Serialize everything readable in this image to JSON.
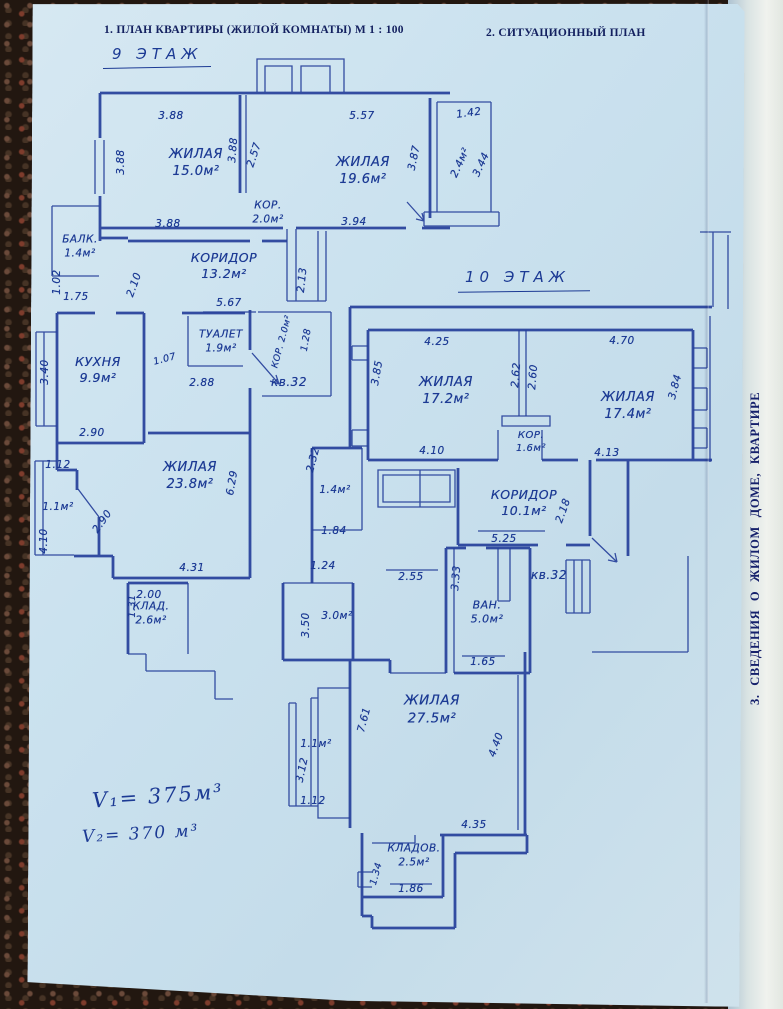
{
  "document": {
    "header_left": "1. ПЛАН КВАРТИРЫ (ЖИЛОЙ КОМНАТЫ) М 1 : 100",
    "header_right": "2. СИТУАЦИОННЫЙ ПЛАН",
    "side_note": "3. СВЕДЕНИЯ О ЖИЛОМ ДОМЕ, КВАРТИРЕ",
    "volume_line1": "V₁= 375м³",
    "volume_line2": "V₂= 370 м³"
  },
  "colors": {
    "paper": "#cde1ee",
    "ink_handwriting": "#1c3a94",
    "ink_plan": "#27419b",
    "ink_print": "#13205f",
    "background": "#221710"
  },
  "floor9": {
    "title": "9 ЭТАЖ",
    "labels": [
      {
        "t": "ЖИЛАЯ\n15.0м²",
        "x": 196,
        "y": 164,
        "s": 13
      },
      {
        "t": "ЖИЛАЯ\n19.6м²",
        "x": 363,
        "y": 172,
        "s": 13
      },
      {
        "t": "КОР.\n2.0м²",
        "x": 268,
        "y": 213,
        "s": 10.5
      },
      {
        "t": "БАЛК.\n1.4м²",
        "x": 80,
        "y": 247,
        "s": 10.5
      },
      {
        "t": "КОРИДОР\n13.2м²",
        "x": 224,
        "y": 266,
        "s": 12.5
      },
      {
        "t": "ТУАЛЕТ\n1.9м²",
        "x": 221,
        "y": 342,
        "s": 10.5
      },
      {
        "t": "КУХНЯ\n9.9м²",
        "x": 98,
        "y": 370,
        "s": 12.5
      },
      {
        "t": "ЖИЛАЯ\n23.8м²",
        "x": 190,
        "y": 477,
        "s": 13
      },
      {
        "t": "КЛАД.\n2.6м²",
        "x": 151,
        "y": 614,
        "s": 10.5
      },
      {
        "t": "1.1м²",
        "x": 58,
        "y": 508,
        "s": 10.5
      },
      {
        "t": "2.4м²",
        "x": 461,
        "y": 163,
        "r": -65,
        "s": 10.5
      },
      {
        "t": "кв.32",
        "x": 289,
        "y": 383,
        "s": 12
      },
      {
        "t": "3.88",
        "x": 171,
        "y": 117
      },
      {
        "t": "5.57",
        "x": 362,
        "y": 117
      },
      {
        "t": "1.42",
        "x": 469,
        "y": 114,
        "r": -8
      },
      {
        "t": "3.88",
        "x": 122,
        "y": 162,
        "r": -90
      },
      {
        "t": "3.88",
        "x": 234,
        "y": 150,
        "r": -85
      },
      {
        "t": "2.57",
        "x": 255,
        "y": 155,
        "r": -72
      },
      {
        "t": "3.87",
        "x": 415,
        "y": 158,
        "r": -78
      },
      {
        "t": "3.44",
        "x": 482,
        "y": 165,
        "r": -65
      },
      {
        "t": "3.88",
        "x": 168,
        "y": 225
      },
      {
        "t": "3.94",
        "x": 354,
        "y": 223
      },
      {
        "t": "1.02",
        "x": 58,
        "y": 282,
        "r": -90
      },
      {
        "t": "1.75",
        "x": 76,
        "y": 298
      },
      {
        "t": "2.10",
        "x": 135,
        "y": 285,
        "r": -70
      },
      {
        "t": "2.13",
        "x": 303,
        "y": 280,
        "r": -84
      },
      {
        "t": "5.67",
        "x": 229,
        "y": 304
      },
      {
        "t": "КОР. 2.0м²",
        "x": 283,
        "y": 342,
        "r": -75,
        "s": 9
      },
      {
        "t": "1.28",
        "x": 307,
        "y": 340,
        "r": -80,
        "s": 9.5
      },
      {
        "t": "3.40",
        "x": 46,
        "y": 372,
        "r": -90
      },
      {
        "t": "1.07",
        "x": 165,
        "y": 360,
        "r": -15,
        "s": 9.5
      },
      {
        "t": "2.88",
        "x": 202,
        "y": 384
      },
      {
        "t": "2.90",
        "x": 92,
        "y": 434
      },
      {
        "t": "1.12",
        "x": 58,
        "y": 466
      },
      {
        "t": "2.90",
        "x": 103,
        "y": 522,
        "r": -55
      },
      {
        "t": "4.10",
        "x": 45,
        "y": 541,
        "r": -90
      },
      {
        "t": "6.29",
        "x": 233,
        "y": 483,
        "r": -80
      },
      {
        "t": "4.31",
        "x": 192,
        "y": 569
      },
      {
        "t": "2.00",
        "x": 149,
        "y": 596
      },
      {
        "t": "1.31",
        "x": 133,
        "y": 606,
        "r": -90,
        "s": 9.5
      }
    ]
  },
  "floor10": {
    "title": "10 ЭТАЖ",
    "labels": [
      {
        "t": "ЖИЛАЯ\n17.2м²",
        "x": 446,
        "y": 392,
        "s": 13
      },
      {
        "t": "ЖИЛАЯ\n17.4м²",
        "x": 628,
        "y": 407,
        "s": 13
      },
      {
        "t": "КОР.\n1.6м²",
        "x": 531,
        "y": 442,
        "s": 10
      },
      {
        "t": "КОРИДОР\n10.1м²",
        "x": 524,
        "y": 503,
        "s": 12.5
      },
      {
        "t": "ВАН.\n5.0м²",
        "x": 487,
        "y": 613,
        "s": 11
      },
      {
        "t": "3.0м²",
        "x": 337,
        "y": 617,
        "s": 10.5
      },
      {
        "t": "1.4м²",
        "x": 335,
        "y": 491,
        "s": 10.5
      },
      {
        "t": "ЖИЛАЯ\n27.5м²",
        "x": 432,
        "y": 710,
        "s": 13.5
      },
      {
        "t": "1.1м²",
        "x": 316,
        "y": 745,
        "s": 10.5
      },
      {
        "t": "КЛАДОВ.\n2.5м²",
        "x": 414,
        "y": 856,
        "s": 10.5
      },
      {
        "t": "кв.32",
        "x": 549,
        "y": 576,
        "s": 12
      },
      {
        "t": "4.25",
        "x": 437,
        "y": 343
      },
      {
        "t": "4.70",
        "x": 622,
        "y": 342
      },
      {
        "t": "3.85",
        "x": 378,
        "y": 373,
        "r": -80
      },
      {
        "t": "2.62",
        "x": 517,
        "y": 375,
        "r": -85
      },
      {
        "t": "2.60",
        "x": 534,
        "y": 377,
        "r": -85
      },
      {
        "t": "3.84",
        "x": 676,
        "y": 387,
        "r": -75
      },
      {
        "t": "4.10",
        "x": 432,
        "y": 452
      },
      {
        "t": "4.13",
        "x": 607,
        "y": 454
      },
      {
        "t": "2.32",
        "x": 314,
        "y": 460,
        "r": -75
      },
      {
        "t": "1.84",
        "x": 334,
        "y": 532
      },
      {
        "t": "1.24",
        "x": 323,
        "y": 567
      },
      {
        "t": "2.55",
        "x": 411,
        "y": 578
      },
      {
        "t": "2.18",
        "x": 564,
        "y": 511,
        "r": -70
      },
      {
        "t": "5.25",
        "x": 504,
        "y": 540
      },
      {
        "t": "3.33",
        "x": 457,
        "y": 578,
        "r": -85
      },
      {
        "t": "3.50",
        "x": 307,
        "y": 625,
        "r": -90
      },
      {
        "t": "1.65",
        "x": 483,
        "y": 663
      },
      {
        "t": "7.61",
        "x": 365,
        "y": 720,
        "r": -75
      },
      {
        "t": "4.40",
        "x": 497,
        "y": 745,
        "r": -70
      },
      {
        "t": "3.12",
        "x": 303,
        "y": 770,
        "r": -78
      },
      {
        "t": "1.12",
        "x": 313,
        "y": 802
      },
      {
        "t": "4.35",
        "x": 474,
        "y": 826
      },
      {
        "t": "1.34",
        "x": 377,
        "y": 874,
        "r": -75,
        "s": 9.5
      },
      {
        "t": "1.86",
        "x": 411,
        "y": 890
      }
    ]
  }
}
